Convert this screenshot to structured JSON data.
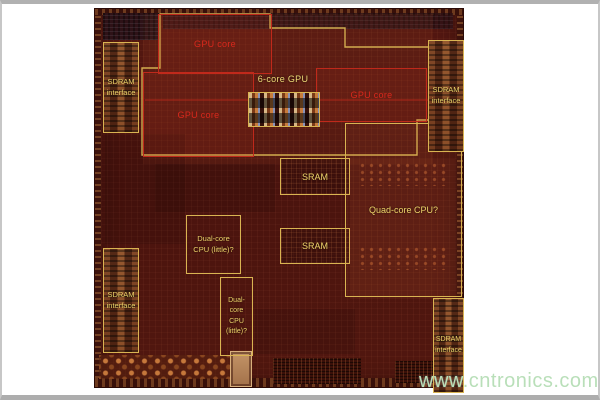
{
  "frame": {
    "background": "#ffffff",
    "border_color": "#b1b1b1"
  },
  "die": {
    "base_color": "#4e150f",
    "red_outline_color": "#c0291b",
    "red_text_color": "#d9281c",
    "yellow_outline_color": "#d9b452",
    "yellow_text_color": "#eed46a",
    "regions": {
      "gpu_core_top": {
        "label": "GPU core"
      },
      "gpu_core_left": {
        "label": "GPU core"
      },
      "gpu_core_right": {
        "label": "GPU core"
      },
      "six_core_gpu": {
        "label": "6-core GPU"
      },
      "sram_top": {
        "label": "SRAM"
      },
      "sram_bottom": {
        "label": "SRAM"
      },
      "quad_core_cpu": {
        "label": "Quad-core CPU?"
      },
      "dual_core_cpu_wide": {
        "label": "Dual-core CPU (little)?",
        "lines": [
          "Dual-core",
          "CPU (little)?"
        ]
      },
      "dual_core_cpu_tall": {
        "label": "Dual-core CPU (little)?",
        "lines": [
          "Dual-",
          "core",
          "CPU",
          "(little)?"
        ]
      },
      "sdram_interface_top_left": {
        "label": "SDRAM interface",
        "lines": [
          "SDRAM",
          "interface"
        ]
      },
      "sdram_interface_top_right": {
        "label": "SDRAM interface",
        "lines": [
          "SDRAM",
          "interface"
        ]
      },
      "sdram_interface_bottom_left": {
        "label": "SDRAM interface",
        "lines": [
          "SDRAM",
          "interface"
        ]
      },
      "sdram_interface_bottom_right": {
        "label": "SDRAM interface",
        "lines": [
          "SDRAM",
          "interface"
        ]
      }
    }
  },
  "watermark": {
    "text": "www.cntronics.com",
    "color": "#b9dfb9"
  }
}
